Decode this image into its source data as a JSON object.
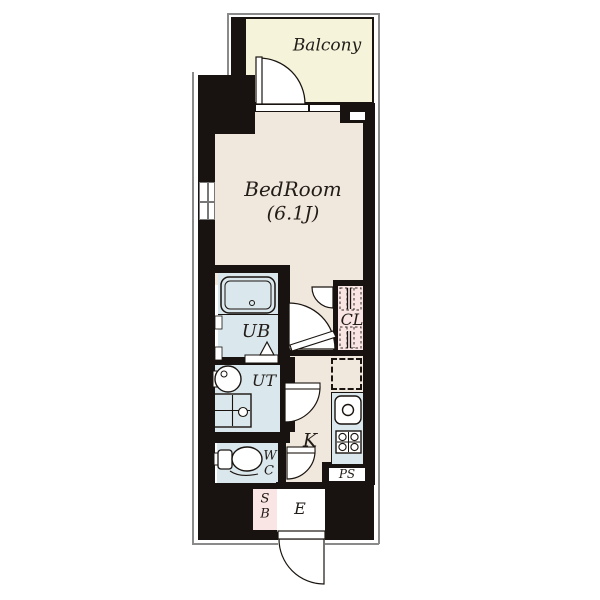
{
  "plan": {
    "type": "apartment-floor-plan",
    "rooms": {
      "balcony": {
        "label": "Balcony"
      },
      "bedroom": {
        "label": "BedRoom",
        "size": "(6.1J)"
      },
      "unit_bath": {
        "label": "UB"
      },
      "utility": {
        "label": "UT"
      },
      "closet": {
        "label": "CL"
      },
      "kitchen": {
        "label": "K"
      },
      "toilet": {
        "line1": "W",
        "line2": "C"
      },
      "pipe_space": {
        "label": "PS"
      },
      "shoe_box": {
        "line1": "S",
        "line2": "B"
      },
      "entrance": {
        "label": "E"
      }
    },
    "palette": {
      "wall": "#181210",
      "balcony_fill": "#f5f3da",
      "room_fill": "#f0e8dd",
      "wet_area_fill": "#dae7ec",
      "closet_fill": "#f8e5e4",
      "outline": "#8a8a8a",
      "text": "#221c18"
    }
  }
}
